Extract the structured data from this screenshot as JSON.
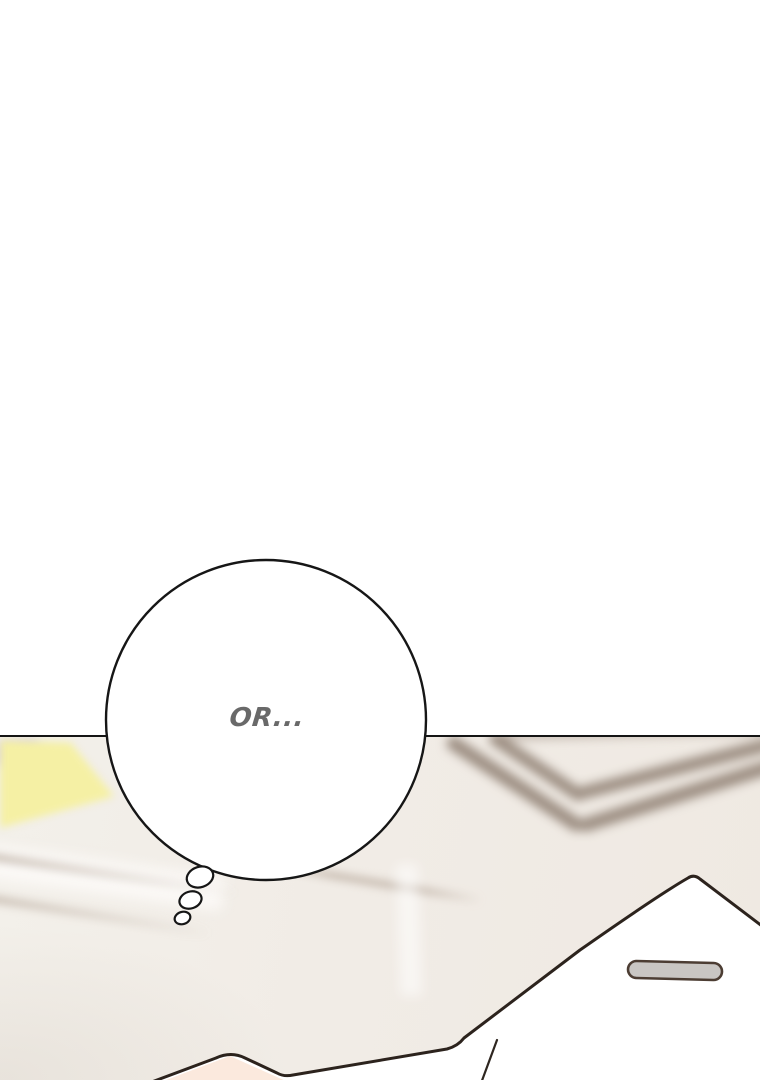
{
  "comic": {
    "panel_type": "webtoon-thought-panel",
    "thought_text": "OR...",
    "colors": {
      "page_background": "#ffffff",
      "panel_line": "#141414",
      "desk_base": "#f1ece6",
      "shadow_streak": "#b0a092",
      "book_yellow": "#f5f0a4",
      "book_lavender": "#d9d1e4",
      "frame_shadow": "#9d8f83",
      "skin_highlight": "#fbe9dd",
      "slot_gray": "#c9c6c3",
      "figure_outline": "#2c231d",
      "thought_text_color": "#696969"
    }
  }
}
